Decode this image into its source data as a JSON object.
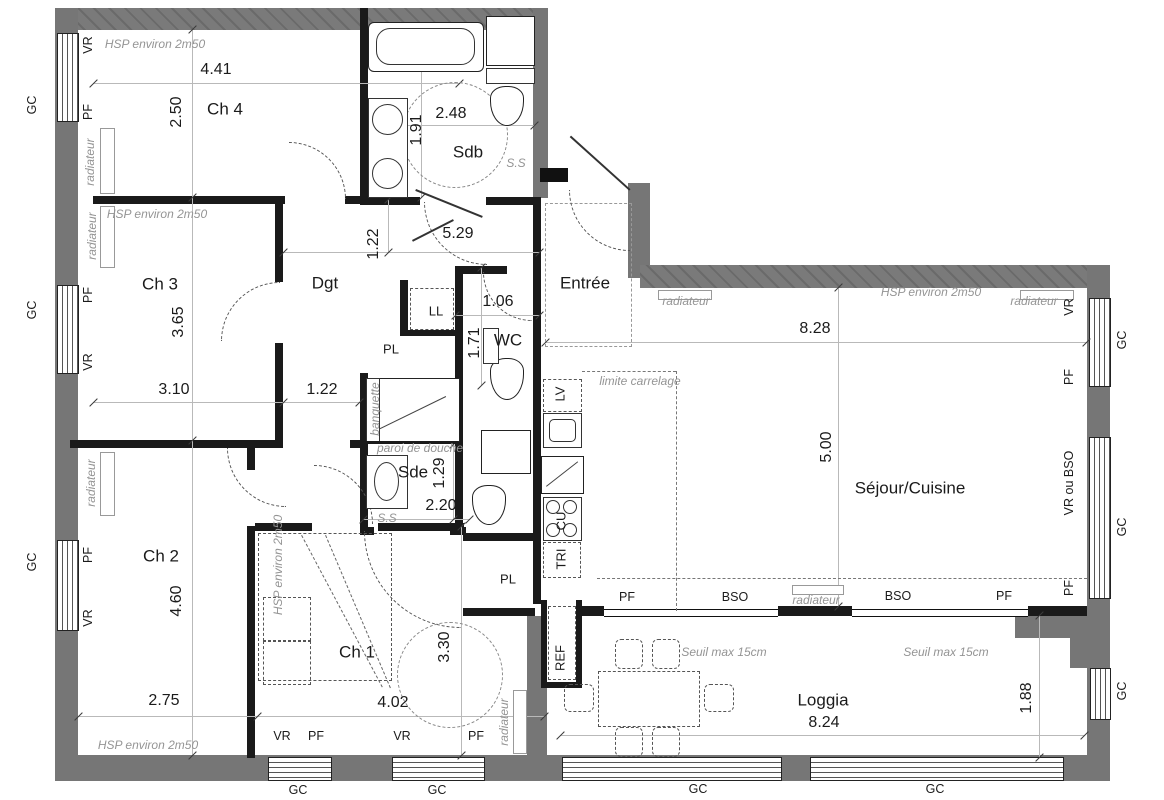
{
  "colors": {
    "wall_exterior": "#767676",
    "wall_interior": "#1a1a1a",
    "dimension_text": "#1b1b1b",
    "annotation_text": "#949494",
    "background": "#ffffff"
  },
  "rooms": [
    {
      "name": "room-ch4",
      "t": "Ch 4",
      "x": 225,
      "y": 109
    },
    {
      "name": "room-ch3",
      "t": "Ch 3",
      "x": 160,
      "y": 284
    },
    {
      "name": "room-ch2",
      "t": "Ch 2",
      "x": 161,
      "y": 556
    },
    {
      "name": "room-ch1",
      "t": "Ch 1",
      "x": 357,
      "y": 652
    },
    {
      "name": "room-sdb",
      "t": "Sdb",
      "x": 468,
      "y": 152
    },
    {
      "name": "room-sde",
      "t": "Sde",
      "x": 413,
      "y": 472
    },
    {
      "name": "room-dgt",
      "t": "Dgt",
      "x": 325,
      "y": 283
    },
    {
      "name": "room-wc",
      "t": "WC",
      "x": 508,
      "y": 340
    },
    {
      "name": "room-entree",
      "t": "Entrée",
      "x": 585,
      "y": 283
    },
    {
      "name": "room-sejour-cuisine",
      "t": "Séjour/Cuisine",
      "x": 910,
      "y": 488
    },
    {
      "name": "room-loggia",
      "t": "Loggia",
      "x": 823,
      "y": 700
    }
  ],
  "closets": [
    {
      "name": "closet-pl-1",
      "t": "PL",
      "x": 391,
      "y": 349
    },
    {
      "name": "closet-pl-2",
      "t": "PL",
      "x": 508,
      "y": 579
    },
    {
      "name": "closet-ll",
      "t": "LL",
      "x": 436,
      "y": 311
    }
  ],
  "appliances": [
    {
      "name": "appliance-lv",
      "t": "LV",
      "x": 560,
      "y": 394,
      "v": 1
    },
    {
      "name": "appliance-cu",
      "t": "CU",
      "x": 561,
      "y": 521,
      "v": 1
    },
    {
      "name": "appliance-tri",
      "t": "TRI",
      "x": 561,
      "y": 559,
      "v": 1
    },
    {
      "name": "appliance-ref",
      "t": "REF",
      "x": 560,
      "y": 658,
      "v": 1
    }
  ],
  "dimensions": [
    {
      "name": "dim-ch4-width",
      "t": "4.41",
      "x": 216,
      "y": 70
    },
    {
      "name": "dim-ch4-height",
      "t": "2.50",
      "x": 177,
      "y": 112,
      "v": 1
    },
    {
      "name": "dim-sdb-width",
      "t": "2.48",
      "x": 451,
      "y": 114
    },
    {
      "name": "dim-sdb-height",
      "t": "1.91",
      "x": 417,
      "y": 130,
      "v": 1
    },
    {
      "name": "dim-dgt-length",
      "t": "5.29",
      "x": 458,
      "y": 234
    },
    {
      "name": "dim-dgt-top",
      "t": "1.22",
      "x": 374,
      "y": 244,
      "v": 1
    },
    {
      "name": "dim-wc-width",
      "t": "1.06",
      "x": 498,
      "y": 302
    },
    {
      "name": "dim-wc-height",
      "t": "1.71",
      "x": 475,
      "y": 343,
      "v": 1
    },
    {
      "name": "dim-ch3-height",
      "t": "3.65",
      "x": 179,
      "y": 322,
      "v": 1
    },
    {
      "name": "dim-ch3-width",
      "t": "3.10",
      "x": 174,
      "y": 390
    },
    {
      "name": "dim-dgt-width",
      "t": "1.22",
      "x": 322,
      "y": 390
    },
    {
      "name": "dim-sejour-width",
      "t": "8.28",
      "x": 815,
      "y": 329
    },
    {
      "name": "dim-sejour-height",
      "t": "5.00",
      "x": 827,
      "y": 447,
      "v": 1
    },
    {
      "name": "dim-sde-width",
      "t": "2.20",
      "x": 441,
      "y": 506
    },
    {
      "name": "dim-sde-height",
      "t": "1.29",
      "x": 440,
      "y": 473,
      "v": 1
    },
    {
      "name": "dim-ch2-height",
      "t": "4.60",
      "x": 177,
      "y": 601,
      "v": 1
    },
    {
      "name": "dim-ch2-width",
      "t": "2.75",
      "x": 164,
      "y": 701
    },
    {
      "name": "dim-ch1-height",
      "t": "3.30",
      "x": 445,
      "y": 647,
      "v": 1
    },
    {
      "name": "dim-ch1-width",
      "t": "4.02",
      "x": 393,
      "y": 703
    },
    {
      "name": "dim-loggia-width",
      "t": "8.24",
      "x": 824,
      "y": 723
    },
    {
      "name": "dim-loggia-depth",
      "t": "1.88",
      "x": 1027,
      "y": 698,
      "v": 1
    }
  ],
  "annotations": [
    {
      "name": "ann-hsp-ch4",
      "t": "HSP environ 2m50",
      "x": 155,
      "y": 44
    },
    {
      "name": "ann-hsp-ch3",
      "t": "HSP environ 2m50",
      "x": 157,
      "y": 214
    },
    {
      "name": "ann-hsp-ch2",
      "t": "HSP environ 2m50",
      "x": 148,
      "y": 745
    },
    {
      "name": "ann-hsp-sejour",
      "t": "HSP environ 2m50",
      "x": 931,
      "y": 292
    },
    {
      "name": "ann-hsp-ch1",
      "t": "HSP environ 2m50",
      "x": 278,
      "y": 565,
      "v": 1
    },
    {
      "name": "ann-radiateur-ch4",
      "t": "radiateur",
      "x": 90,
      "y": 162,
      "v": 1
    },
    {
      "name": "ann-radiateur-ch3",
      "t": "radiateur",
      "x": 92,
      "y": 236,
      "v": 1
    },
    {
      "name": "ann-radiateur-ch2",
      "t": "radiateur",
      "x": 91,
      "y": 483,
      "v": 1
    },
    {
      "name": "ann-radiateur-entree",
      "t": "radiateur",
      "x": 686,
      "y": 301
    },
    {
      "name": "ann-radiateur-sejour-1",
      "t": "radiateur",
      "x": 1034,
      "y": 301
    },
    {
      "name": "ann-radiateur-sejour-2",
      "t": "radiateur",
      "x": 816,
      "y": 600
    },
    {
      "name": "ann-radiateur-ch1",
      "t": "radiateur",
      "x": 504,
      "y": 722,
      "v": 1
    },
    {
      "name": "ann-limite-carrelage",
      "t": "limite carrelage",
      "x": 640,
      "y": 381
    },
    {
      "name": "ann-paroi-de-douche",
      "t": "paroi de douche",
      "x": 420,
      "y": 448
    },
    {
      "name": "ann-banquette",
      "t": "banquette",
      "x": 375,
      "y": 409,
      "v": 1
    },
    {
      "name": "ann-ss-sdb",
      "t": "S.S",
      "x": 516,
      "y": 163
    },
    {
      "name": "ann-ss-sde",
      "t": "S.S",
      "x": 387,
      "y": 518
    },
    {
      "name": "ann-seuil-1",
      "t": "Seuil max 15cm",
      "x": 724,
      "y": 652
    },
    {
      "name": "ann-seuil-2",
      "t": "Seuil max 15cm",
      "x": 946,
      "y": 652
    }
  ],
  "edge_labels": [
    {
      "name": "edge-gc-left-1",
      "t": "GC",
      "x": 32,
      "y": 105,
      "v": 1
    },
    {
      "name": "edge-gc-left-2",
      "t": "GC",
      "x": 32,
      "y": 310,
      "v": 1
    },
    {
      "name": "edge-gc-left-3",
      "t": "GC",
      "x": 32,
      "y": 562,
      "v": 1
    },
    {
      "name": "edge-gc-right-1",
      "t": "GC",
      "x": 1122,
      "y": 340,
      "v": 1
    },
    {
      "name": "edge-gc-right-2",
      "t": "GC",
      "x": 1122,
      "y": 527,
      "v": 1
    },
    {
      "name": "edge-gc-right-3",
      "t": "GC",
      "x": 1122,
      "y": 691,
      "v": 1
    },
    {
      "name": "edge-gc-bottom-1",
      "t": "GC",
      "x": 298,
      "y": 790
    },
    {
      "name": "edge-gc-bottom-2",
      "t": "GC",
      "x": 437,
      "y": 790
    },
    {
      "name": "edge-gc-bottom-3",
      "t": "GC",
      "x": 698,
      "y": 789
    },
    {
      "name": "edge-gc-bottom-4",
      "t": "GC",
      "x": 935,
      "y": 789
    },
    {
      "name": "edge-vr-ch4",
      "t": "VR",
      "x": 88,
      "y": 45,
      "v": 1
    },
    {
      "name": "edge-pf-ch4",
      "t": "PF",
      "x": 88,
      "y": 112,
      "v": 1
    },
    {
      "name": "edge-pf-ch3",
      "t": "PF",
      "x": 88,
      "y": 295,
      "v": 1
    },
    {
      "name": "edge-vr-ch3",
      "t": "VR",
      "x": 88,
      "y": 362,
      "v": 1
    },
    {
      "name": "edge-pf-ch2",
      "t": "PF",
      "x": 88,
      "y": 555,
      "v": 1
    },
    {
      "name": "edge-vr-ch2",
      "t": "VR",
      "x": 88,
      "y": 618,
      "v": 1
    },
    {
      "name": "edge-vr-sejour",
      "t": "VR",
      "x": 1069,
      "y": 307,
      "v": 1
    },
    {
      "name": "edge-pf-sejour-1",
      "t": "PF",
      "x": 1069,
      "y": 377,
      "v": 1
    },
    {
      "name": "edge-vr-ou-bso",
      "t": "VR ou BSO",
      "x": 1069,
      "y": 483,
      "v": 1
    },
    {
      "name": "edge-pf-sejour-2",
      "t": "PF",
      "x": 1069,
      "y": 588,
      "v": 1
    },
    {
      "name": "edge-vr-ch1-1",
      "t": "VR",
      "x": 282,
      "y": 736
    },
    {
      "name": "edge-pf-ch1-1",
      "t": "PF",
      "x": 316,
      "y": 736
    },
    {
      "name": "edge-vr-ch1-2",
      "t": "VR",
      "x": 402,
      "y": 736
    },
    {
      "name": "edge-pf-ch1-2",
      "t": "PF",
      "x": 476,
      "y": 736
    },
    {
      "name": "edge-pf-loggia-1",
      "t": "PF",
      "x": 627,
      "y": 597
    },
    {
      "name": "edge-bso-1",
      "t": "BSO",
      "x": 735,
      "y": 597
    },
    {
      "name": "edge-bso-2",
      "t": "BSO",
      "x": 898,
      "y": 596
    },
    {
      "name": "edge-pf-loggia-2",
      "t": "PF",
      "x": 1004,
      "y": 596
    }
  ],
  "fixtures": [
    "bathtub-icon",
    "washbasin-icon",
    "toilet-icon",
    "shower-icon",
    "washing-machine-icon",
    "dishwasher-icon",
    "kitchen-sink-icon",
    "oven-icon",
    "hob-icon",
    "fridge-icon",
    "radiator-icon",
    "dining-table-icon",
    "chair-icon",
    "wardrobe-icon",
    "door-arc-icon",
    "turning-circle-icon",
    "window-icon"
  ]
}
